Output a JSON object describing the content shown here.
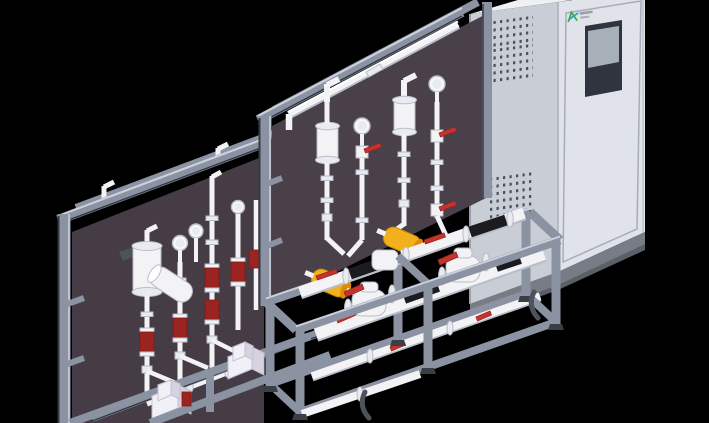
{
  "scene": {
    "description": "Isometric 3D CAD render: two chemical dosing skid assemblies with aluminum extrusion frames, dark mounting panels, white piping with red valve handles, yellow pulsation dampeners and metering pumps, placed beside a light gray control cabinet with an HMI screen",
    "visible_text": "none legible (tiny gray brand characters beside logo mark are unreadable)"
  },
  "colors": {
    "background": "#000000",
    "alu": "#8b93a3",
    "alu_dark": "#343944",
    "alu_light": "#ccd2dd",
    "panel_rear": "#453c45",
    "panel_front": "#4a4049",
    "pipe": "#f3f3f6",
    "pipe_shade": "#b9bdc8",
    "black_pipe": "#1b1b20",
    "red": "#c4342c",
    "red_dark": "#9c2420",
    "yellow": "#f2b01c",
    "yellow_dark": "#dd8a07",
    "cab_side": "#c9cdd6",
    "cab_front": "#e0e3e9",
    "cab_top": "#eef0f4",
    "cab_base": "#787c86",
    "cab_base_dark": "#5b5f67",
    "screen_bezel": "#30343e",
    "screen_display": "#a7b0b8",
    "logo_green": "#3fae49",
    "logo_blue": "#2e9fd0",
    "vent_dot": "#4a4e58",
    "pump_body": "#f2f0f7",
    "pump_top": "#e6e2ee",
    "pump_side": "#d6d2e0",
    "foot": "#3a3e46",
    "lever": "#4d525c"
  },
  "cabinet": {
    "name": "control-cabinet",
    "screen": "hmi-screen (dark bezel, gray display)",
    "logo": "brand-logo-mark (green + blue strokes, illegible gray text)",
    "vent_grids": 3,
    "door": "front door with inset frame outline"
  },
  "skids": [
    {
      "name": "rear-dosing-skid",
      "components": [
        "frame-posts",
        "top-beams",
        "dark-panel",
        "pulsation-damper-cylinder",
        "angled-cylinder",
        "pressure-gauges",
        "vertical-pipes",
        "red-valve-bodies",
        "metering-pumps",
        "base-rails"
      ]
    },
    {
      "name": "front-dosing-skid",
      "components": [
        "frame-posts",
        "top-beam",
        "top-header-pipe",
        "dark-panel",
        "damper-cylinders",
        "pressure-gauges",
        "red-lever-valves",
        "yellow-dampeners",
        "deck-frame",
        "manifold-trains",
        "black-pipe-spools",
        "diaphragm-valves",
        "legs-and-feet",
        "dark-levers"
      ]
    }
  ]
}
